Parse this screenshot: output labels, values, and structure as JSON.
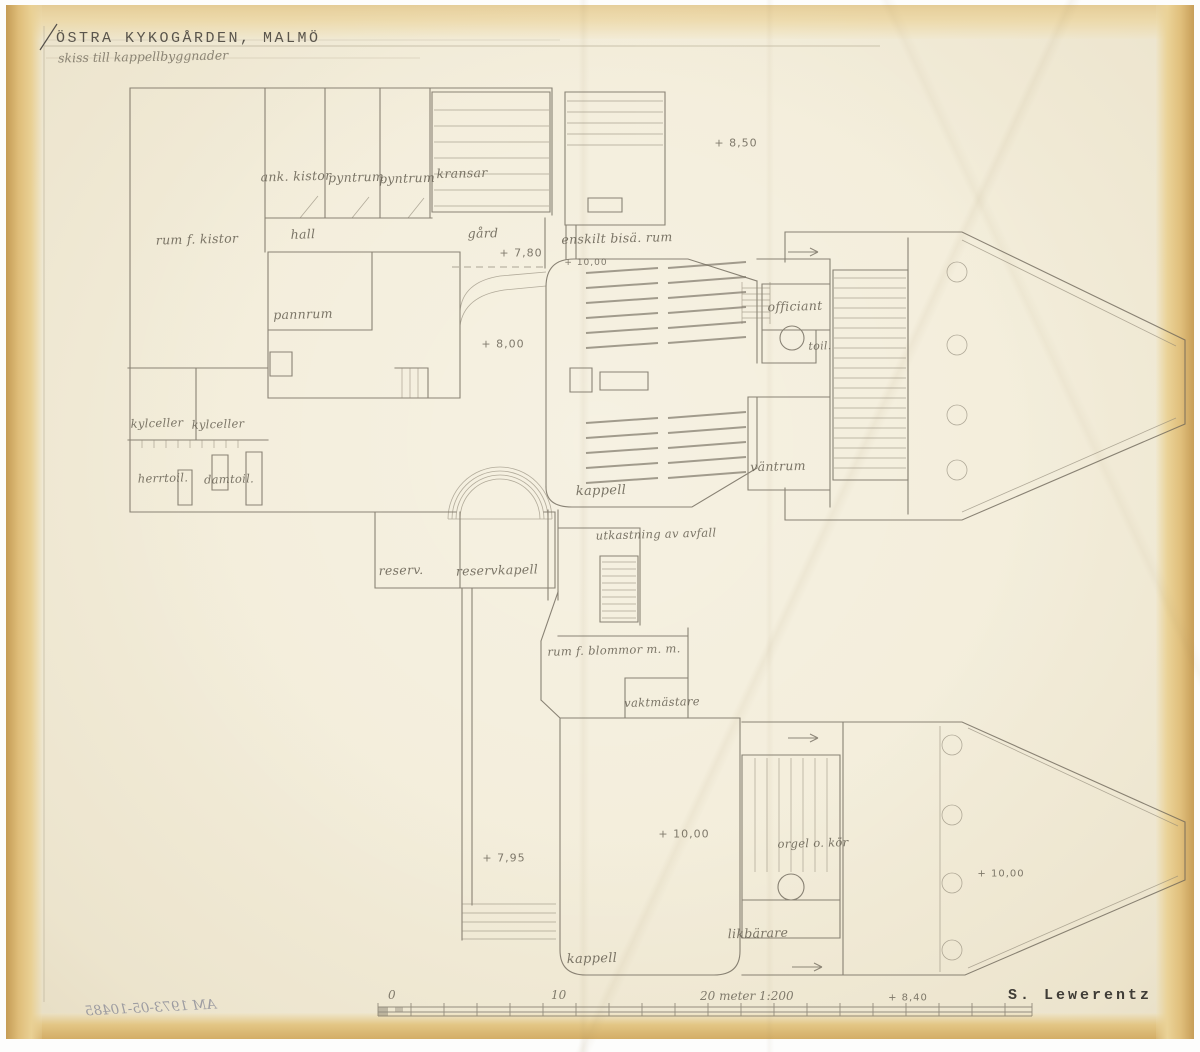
{
  "title": {
    "main": "ÖSTRA KYKOGÅRDEN, MALMÖ",
    "subtitle": "skiss till kappellbyggnader"
  },
  "signature": "S. Lewerentz",
  "stamp": "AM 1973-05-10485",
  "scale_bar": {
    "tick_0": "0",
    "tick_10": "10",
    "tick_20": "20 meter 1:200"
  },
  "colors": {
    "paper": "#f3edda",
    "paper_edge": "#d9b068",
    "pencil": "#6b6457",
    "handwriting": "#6a6456",
    "typewriter": "#4a463e"
  },
  "room_labels": [
    {
      "text": "ank. kistor",
      "x": 296,
      "y": 176
    },
    {
      "text": "pyntrum",
      "x": 356,
      "y": 177
    },
    {
      "text": "pyntrum",
      "x": 407,
      "y": 178
    },
    {
      "text": "kransar",
      "x": 462,
      "y": 173
    },
    {
      "text": "rum f. kistor",
      "x": 197,
      "y": 239
    },
    {
      "text": "hall",
      "x": 303,
      "y": 234
    },
    {
      "text": "gård",
      "x": 483,
      "y": 233
    },
    {
      "text": "enskilt bisä. rum",
      "x": 617,
      "y": 238
    },
    {
      "text": "pannrum",
      "x": 303,
      "y": 314
    },
    {
      "text": "officiant",
      "x": 795,
      "y": 306
    },
    {
      "text": "toil.",
      "x": 820,
      "y": 346,
      "size": 11
    },
    {
      "text": "kylceller",
      "x": 157,
      "y": 423,
      "size": 11.5
    },
    {
      "text": "kylceller",
      "x": 218,
      "y": 424,
      "size": 11.5
    },
    {
      "text": "herrtoil.",
      "x": 163,
      "y": 478,
      "size": 11.5
    },
    {
      "text": "damtoil.",
      "x": 229,
      "y": 479,
      "size": 11.5
    },
    {
      "text": "väntrum",
      "x": 778,
      "y": 466
    },
    {
      "text": "kappell",
      "x": 601,
      "y": 491,
      "size": 13
    },
    {
      "text": "utkastning av avfall",
      "x": 656,
      "y": 534,
      "size": 11.5
    },
    {
      "text": "reserv.",
      "x": 401,
      "y": 570
    },
    {
      "text": "reservkapell",
      "x": 497,
      "y": 570
    },
    {
      "text": "rum f. blommor m. m.",
      "x": 614,
      "y": 650,
      "size": 11.5
    },
    {
      "text": "vaktmästare",
      "x": 662,
      "y": 702,
      "size": 11.5
    },
    {
      "text": "orgel o. kör",
      "x": 813,
      "y": 843,
      "size": 11.5
    },
    {
      "text": "likbärare",
      "x": 758,
      "y": 933
    },
    {
      "text": "kappell",
      "x": 592,
      "y": 959,
      "size": 13
    }
  ],
  "elevation_marks": [
    {
      "text": "+ 8,50",
      "x": 736,
      "y": 143
    },
    {
      "text": "+ 7,80",
      "x": 521,
      "y": 253
    },
    {
      "text": "+ 10,00",
      "x": 586,
      "y": 263,
      "size": 9
    },
    {
      "text": "+ 8,00",
      "x": 503,
      "y": 344
    },
    {
      "text": "+ 10,00",
      "x": 684,
      "y": 834
    },
    {
      "text": "+ 7,95",
      "x": 504,
      "y": 858
    },
    {
      "text": "+ 10,00",
      "x": 1001,
      "y": 874,
      "size": 10
    },
    {
      "text": "+ 8,40",
      "x": 908,
      "y": 998,
      "size": 10
    }
  ]
}
